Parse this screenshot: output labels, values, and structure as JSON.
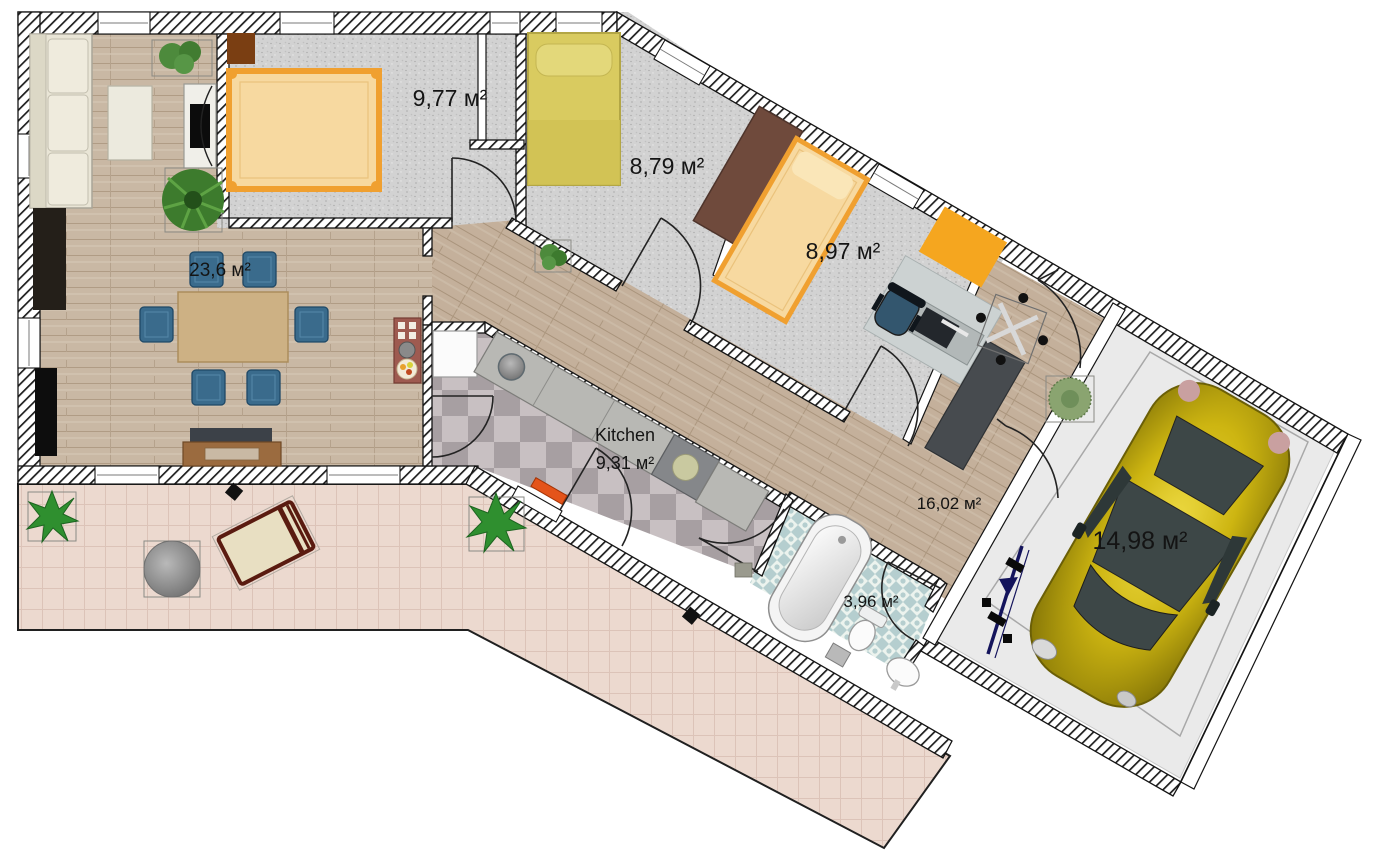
{
  "plan": {
    "rooms": {
      "bedroom1": {
        "area_label": "9,77 м²"
      },
      "bedroom2": {
        "area_label": "8,79 м²"
      },
      "bedroom3": {
        "area_label": "8,97 м²"
      },
      "living": {
        "area_label": "23,6 м²"
      },
      "kitchen": {
        "name_label": "Kitchen",
        "area_label": "9,31 м²"
      },
      "hall": {
        "area_label": "16,02 м²"
      },
      "bathroom": {
        "area_label": "3,96 м²"
      },
      "garage": {
        "area_label": "14,98 м²"
      }
    },
    "colors": {
      "bed_frame": "#f0a030",
      "bed_fill": "#f7d9a0",
      "bed2_fill": "#d9cb60",
      "chair_blue": "#3a6b8c",
      "car_yellow": "#cdb511",
      "rug_orange": "#f5a61f",
      "terrace_tile": "#ecd9cf",
      "bath_tile": "#b5cecf",
      "wall_line": "#141414"
    }
  }
}
